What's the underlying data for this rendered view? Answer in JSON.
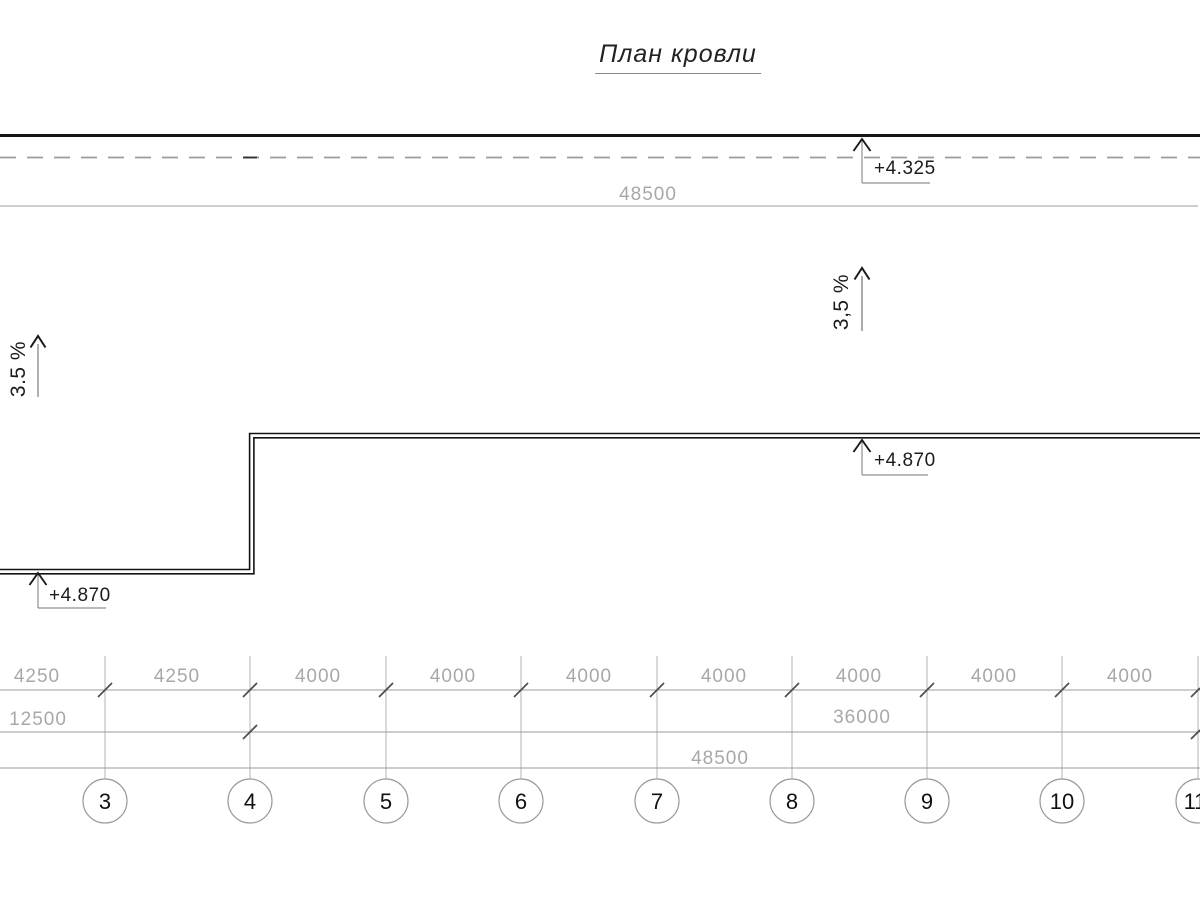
{
  "title": "План кровли",
  "roof": {
    "parapet_elevation": "+4.325",
    "upper_roof_elevation_right": "+4.870",
    "upper_roof_elevation_left": "+4.870",
    "slope_left": "3.5 %",
    "slope_right": "3,5 %"
  },
  "dimensions": {
    "top_total": "48500",
    "segments": [
      "4250",
      "4250",
      "4000",
      "4000",
      "4000",
      "4000",
      "4000",
      "4000",
      "4000"
    ],
    "subtotals": [
      "12500",
      "36000"
    ],
    "grand_total": "48500"
  },
  "axes": {
    "labels": [
      "3",
      "4",
      "5",
      "6",
      "7",
      "8",
      "9",
      "10",
      "11"
    ]
  },
  "colors": {
    "line_gray": "#9b9b9b",
    "text_gray": "#a8a8a8",
    "ink": "#1a1a1a"
  }
}
